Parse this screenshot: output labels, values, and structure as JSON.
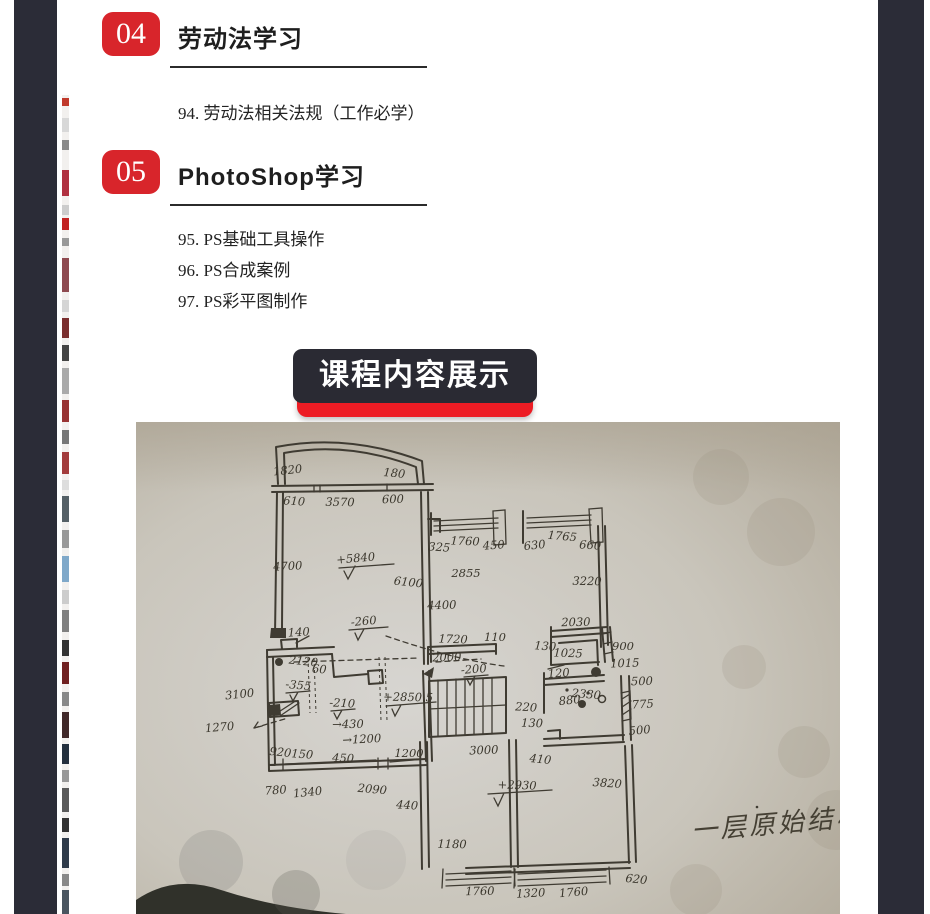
{
  "frame_color": "#2b2c37",
  "sections": [
    {
      "badge": "04",
      "title": "劳动法学习",
      "items": [
        "94. 劳动法相关法规（工作必学）"
      ]
    },
    {
      "badge": "05",
      "title": "PhotoShop学习",
      "items": [
        "95. PS基础工具操作",
        "96. PS合成案例",
        "97. PS彩平图制作"
      ]
    }
  ],
  "banner": {
    "label": "课程内容展示",
    "bg": "#2a2a33",
    "accent": "#ed1c24",
    "text_color": "#ffffff"
  },
  "badge_color": "#d8252b",
  "photo": {
    "description": "photo of hand-drawn floor plan sketch on beige paper",
    "caption": "一层原始结构图",
    "paper_color": "#c9c4b9",
    "ink_color": "#3f3b32",
    "labels": [
      {
        "t": "1820",
        "x": 152,
        "y": 52
      },
      {
        "t": "180",
        "x": 258,
        "y": 55
      },
      {
        "t": "610",
        "x": 158,
        "y": 83
      },
      {
        "t": "3570",
        "x": 204,
        "y": 84
      },
      {
        "t": "600",
        "x": 257,
        "y": 81
      },
      {
        "t": "4700",
        "x": 152,
        "y": 148
      },
      {
        "t": "+5840",
        "x": 220,
        "y": 140
      },
      {
        "t": "6100",
        "x": 272,
        "y": 164
      },
      {
        "t": "325",
        "x": 303,
        "y": 129
      },
      {
        "t": "1760",
        "x": 329,
        "y": 123
      },
      {
        "t": "2855",
        "x": 330,
        "y": 155
      },
      {
        "t": "4400",
        "x": 306,
        "y": 187
      },
      {
        "t": "450",
        "x": 358,
        "y": 127
      },
      {
        "t": "630",
        "x": 399,
        "y": 127
      },
      {
        "t": "1765",
        "x": 426,
        "y": 118
      },
      {
        "t": "660",
        "x": 454,
        "y": 127
      },
      {
        "t": "3220",
        "x": 451,
        "y": 163
      },
      {
        "t": "2030",
        "x": 440,
        "y": 204
      },
      {
        "t": "140",
        "x": 163,
        "y": 214
      },
      {
        "t": "-260",
        "x": 228,
        "y": 203
      },
      {
        "t": "2120",
        "x": 167,
        "y": 243
      },
      {
        "t": "60",
        "x": 183,
        "y": 251
      },
      {
        "t": "1720",
        "x": 317,
        "y": 221
      },
      {
        "t": "110",
        "x": 359,
        "y": 219
      },
      {
        "t": "2000",
        "x": 311,
        "y": 239
      },
      {
        "t": "-200",
        "x": 338,
        "y": 251
      },
      {
        "t": "3100",
        "x": 104,
        "y": 276
      },
      {
        "t": "-355",
        "x": 162,
        "y": 267
      },
      {
        "t": "-210",
        "x": 206,
        "y": 285
      },
      {
        "t": "+2850.5",
        "x": 272,
        "y": 279
      },
      {
        "t": "→430",
        "x": 212,
        "y": 306
      },
      {
        "t": "→1200",
        "x": 226,
        "y": 321
      },
      {
        "t": "1270",
        "x": 84,
        "y": 309
      },
      {
        "t": "920",
        "x": 144,
        "y": 334
      },
      {
        "t": "150",
        "x": 166,
        "y": 336
      },
      {
        "t": "450",
        "x": 207,
        "y": 340
      },
      {
        "t": "1200",
        "x": 273,
        "y": 335
      },
      {
        "t": "3000",
        "x": 348,
        "y": 332
      },
      {
        "t": "780",
        "x": 140,
        "y": 372
      },
      {
        "t": "1340",
        "x": 172,
        "y": 374
      },
      {
        "t": "2090",
        "x": 236,
        "y": 371
      },
      {
        "t": "440",
        "x": 271,
        "y": 387
      },
      {
        "t": "1180",
        "x": 316,
        "y": 426
      },
      {
        "t": "1760",
        "x": 344,
        "y": 473
      },
      {
        "t": "1320",
        "x": 395,
        "y": 475
      },
      {
        "t": "1760",
        "x": 438,
        "y": 474
      },
      {
        "t": "620",
        "x": 500,
        "y": 461
      },
      {
        "t": "130",
        "x": 409,
        "y": 228
      },
      {
        "t": "1025",
        "x": 432,
        "y": 235
      },
      {
        "t": "900",
        "x": 487,
        "y": 228
      },
      {
        "t": "1015",
        "x": 489,
        "y": 245
      },
      {
        "t": "120",
        "x": 423,
        "y": 255
      },
      {
        "t": "880",
        "x": 434,
        "y": 282
      },
      {
        "t": "2330",
        "x": 450,
        "y": 276
      },
      {
        "t": "220",
        "x": 390,
        "y": 289
      },
      {
        "t": "130",
        "x": 396,
        "y": 305
      },
      {
        "t": "500",
        "x": 506,
        "y": 263
      },
      {
        "t": "775",
        "x": 507,
        "y": 286
      },
      {
        "t": "500",
        "x": 504,
        "y": 312
      },
      {
        "t": "410",
        "x": 404,
        "y": 341
      },
      {
        "t": "3820",
        "x": 471,
        "y": 365
      },
      {
        "t": "+2930",
        "x": 381,
        "y": 367
      }
    ]
  },
  "edge_strip": {
    "fragments": [
      {
        "top": 3,
        "h": 8,
        "c": "#c0392b"
      },
      {
        "top": 23,
        "h": 14,
        "c": "#d8d8d8"
      },
      {
        "top": 45,
        "h": 10,
        "c": "#8a8a8a"
      },
      {
        "top": 75,
        "h": 26,
        "c": "#b03040"
      },
      {
        "top": 110,
        "h": 10,
        "c": "#cccccc"
      },
      {
        "top": 123,
        "h": 12,
        "c": "#c22222"
      },
      {
        "top": 143,
        "h": 8,
        "c": "#999999"
      },
      {
        "top": 163,
        "h": 34,
        "c": "#8f4a50"
      },
      {
        "top": 205,
        "h": 12,
        "c": "#d5d5d5"
      },
      {
        "top": 223,
        "h": 20,
        "c": "#7a2e2e"
      },
      {
        "top": 250,
        "h": 16,
        "c": "#444444"
      },
      {
        "top": 273,
        "h": 26,
        "c": "#aaaaaa"
      },
      {
        "top": 305,
        "h": 22,
        "c": "#993333"
      },
      {
        "top": 335,
        "h": 14,
        "c": "#777777"
      },
      {
        "top": 357,
        "h": 22,
        "c": "#a33c3c"
      },
      {
        "top": 385,
        "h": 10,
        "c": "#dddddd"
      },
      {
        "top": 401,
        "h": 26,
        "c": "#556066"
      },
      {
        "top": 435,
        "h": 18,
        "c": "#999999"
      },
      {
        "top": 461,
        "h": 26,
        "c": "#7fa8c9"
      },
      {
        "top": 495,
        "h": 14,
        "c": "#cccccc"
      },
      {
        "top": 515,
        "h": 22,
        "c": "#808080"
      },
      {
        "top": 545,
        "h": 16,
        "c": "#333333"
      },
      {
        "top": 567,
        "h": 22,
        "c": "#702020"
      },
      {
        "top": 597,
        "h": 14,
        "c": "#888888"
      },
      {
        "top": 617,
        "h": 26,
        "c": "#402828"
      },
      {
        "top": 649,
        "h": 20,
        "c": "#24303e"
      },
      {
        "top": 675,
        "h": 12,
        "c": "#999999"
      },
      {
        "top": 693,
        "h": 24,
        "c": "#5a5a5a"
      },
      {
        "top": 723,
        "h": 14,
        "c": "#333333"
      },
      {
        "top": 743,
        "h": 30,
        "c": "#2f3b4a"
      },
      {
        "top": 779,
        "h": 12,
        "c": "#888888"
      },
      {
        "top": 795,
        "h": 24,
        "c": "#4a5560"
      }
    ]
  }
}
